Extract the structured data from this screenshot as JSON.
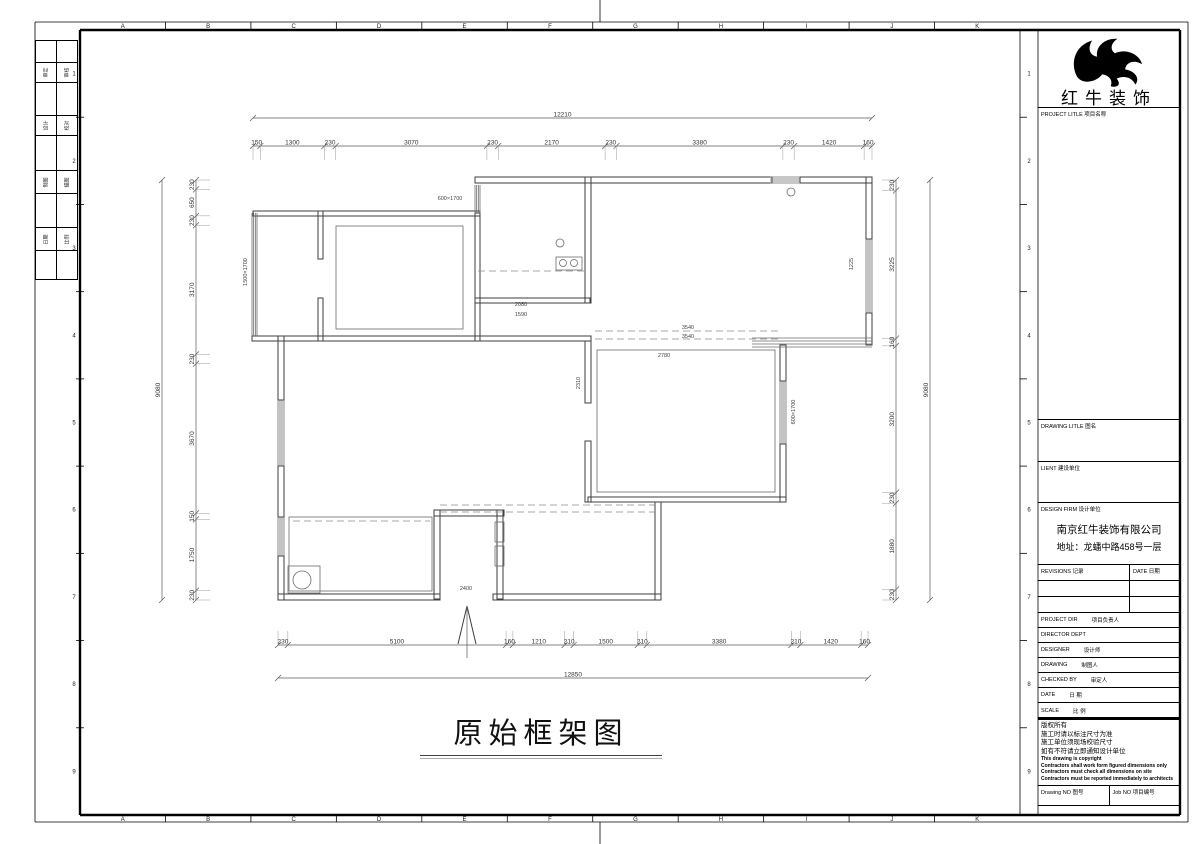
{
  "sheet": {
    "top_letters": [
      "A",
      "B",
      "C",
      "D",
      "E",
      "F",
      "G",
      "H",
      "I",
      "J",
      "K"
    ],
    "side_numbers": [
      "1",
      "2",
      "3",
      "4",
      "5",
      "6",
      "7",
      "8",
      "9"
    ]
  },
  "signature_column": {
    "rows": [
      {
        "h": 22
      },
      {
        "h": 20,
        "cells": [
          "审定",
          "审核"
        ]
      },
      {
        "h": 33
      },
      {
        "h": 20,
        "cells": [
          "设计",
          "校对"
        ]
      },
      {
        "h": 35
      },
      {
        "h": 23,
        "cells": [
          "制图",
          "描图"
        ]
      },
      {
        "h": 34
      },
      {
        "h": 23,
        "cells": [
          "日期",
          "比例"
        ]
      },
      {
        "h": 28
      }
    ]
  },
  "title_block": {
    "brand": "红牛装饰",
    "project_title_label": "PROJECT LITLE  项目名称",
    "drawing_title_label": "DRAWING LITLE  图名",
    "client_label": "LIENT  建设单位",
    "design_firm_label": "DESIGN FIRM  设计单位",
    "firm_name": "南京红牛装饰有限公司",
    "firm_address": "地址：龙蟠中路458号一层",
    "revisions_label": "REVISIONS  记录",
    "date_col_label": "DATE  日期",
    "rows": [
      {
        "label": "PROJECT DIR",
        "cn": "项目负责人"
      },
      {
        "label": "DIRECTOR DEPT",
        "cn": ""
      },
      {
        "label": "DESIGNER",
        "cn": "设计师"
      },
      {
        "label": "DRAWING",
        "cn": "制图人"
      },
      {
        "label": "CHECKED BY",
        "cn": "审定人"
      },
      {
        "label": "DATE",
        "cn": "日  期"
      },
      {
        "label": "SCALE",
        "cn": "比  例"
      }
    ],
    "notes_cn": [
      "版权所有",
      "施工时请以标注尺寸为准",
      "施工单位须现场校验尺寸",
      "如有不符请立即通知设计单位"
    ],
    "notes_en": [
      "This drawing is copyright",
      "Contractors shall work form figured dimensions only",
      "Contractors must check all dimensions on site",
      "Contractors must be reported immediately to architects"
    ],
    "drawing_no_label": "Drawing NO  图号",
    "job_no_label": "Job NO  项目编号"
  },
  "drawing": {
    "title": "原始框架图",
    "walls": [
      [
        253,
        211,
        227,
        5
      ],
      [
        475,
        177,
        297,
        6
      ],
      [
        800,
        177,
        72,
        6
      ],
      [
        866,
        177,
        6,
        62
      ],
      [
        866,
        313,
        6,
        32
      ],
      [
        780,
        345,
        6,
        36
      ],
      [
        780,
        444,
        6,
        58
      ],
      [
        588,
        497,
        198,
        5
      ],
      [
        655,
        502,
        6,
        98
      ],
      [
        278,
        594,
        162,
        6
      ],
      [
        493,
        594,
        168,
        6
      ],
      [
        278,
        336,
        6,
        64
      ],
      [
        278,
        466,
        6,
        51
      ],
      [
        278,
        556,
        6,
        44
      ],
      [
        318,
        211,
        5,
        48
      ],
      [
        318,
        298,
        5,
        43
      ],
      [
        475,
        213,
        5,
        128
      ],
      [
        585,
        177,
        6,
        126
      ],
      [
        475,
        298,
        115,
        5
      ],
      [
        252,
        336,
        339,
        5
      ],
      [
        585,
        341,
        6,
        62
      ],
      [
        585,
        441,
        6,
        61
      ],
      [
        434,
        510,
        6,
        89
      ],
      [
        434,
        510,
        70,
        6
      ],
      [
        497,
        510,
        6,
        89
      ]
    ],
    "windows": [
      [
        252,
        213,
        5,
        123
      ],
      [
        475,
        185,
        5,
        28
      ],
      [
        770,
        177,
        30,
        6
      ],
      [
        866,
        239,
        6,
        74
      ],
      [
        752,
        338,
        120,
        9
      ],
      [
        780,
        381,
        6,
        63
      ],
      [
        278,
        400,
        6,
        66
      ],
      [
        278,
        517,
        6,
        39
      ]
    ],
    "inner_rects": [
      [
        336,
        226,
        127,
        103
      ],
      [
        597,
        350,
        178,
        142
      ],
      [
        289,
        517,
        143,
        74
      ],
      [
        288,
        566,
        32,
        27
      ],
      [
        556,
        257,
        26,
        13
      ],
      [
        495,
        522,
        9,
        20
      ],
      [
        495,
        546,
        9,
        20
      ]
    ],
    "dashed": [
      [
        478,
        271,
        585,
        271
      ],
      [
        595,
        331,
        778,
        331
      ],
      [
        595,
        339,
        778,
        339
      ],
      [
        440,
        505,
        655,
        505
      ],
      [
        440,
        512,
        655,
        512
      ],
      [
        293,
        521,
        430,
        521
      ]
    ],
    "circles": [
      [
        302,
        580,
        9
      ],
      [
        563,
        263,
        3.5
      ],
      [
        574,
        263,
        3.5
      ],
      [
        560,
        243,
        4
      ],
      [
        791,
        192,
        4
      ]
    ],
    "entry_arrow": {
      "points": "458,644 467,606 476,644",
      "stem": [
        467,
        606,
        467,
        658
      ]
    },
    "annotations": [
      [
        466,
        590,
        "2400",
        0
      ],
      [
        664,
        357,
        "2780",
        0
      ],
      [
        688,
        329,
        "3540",
        0
      ],
      [
        688,
        338,
        "3540",
        0
      ],
      [
        450,
        200,
        "600×1700",
        0
      ],
      [
        795,
        412,
        "600×1700",
        -90
      ],
      [
        853,
        264,
        "1225",
        -90
      ],
      [
        521,
        306,
        "2080",
        0
      ],
      [
        521,
        316,
        "1590",
        0
      ],
      [
        580,
        383,
        "2310",
        -90
      ],
      [
        247,
        272,
        "1500×1700",
        -90
      ]
    ],
    "dims": {
      "top_overall": {
        "y": 118,
        "x1": 253,
        "x2": 872,
        "label": "12210"
      },
      "top_chain": {
        "y": 146,
        "x1": 253,
        "x2": 872,
        "guide": "down",
        "values": [
          "150",
          "1300",
          "230",
          "3070",
          "230",
          "2170",
          "230",
          "3380",
          "230",
          "1420",
          "160"
        ]
      },
      "bottom_chain": {
        "y": 645,
        "x1": 278,
        "x2": 868,
        "guide": "up",
        "values": [
          "230",
          "5100",
          "160",
          "1210",
          "210",
          "1500",
          "210",
          "3380",
          "210",
          "1420",
          "160"
        ]
      },
      "bottom_overall": {
        "y": 678,
        "x1": 278,
        "x2": 868,
        "label": "12850"
      },
      "left_chain": {
        "x": 196,
        "y1": 180,
        "y2": 600,
        "guide": "right",
        "values": [
          "230",
          "650",
          "230",
          "3170",
          "230",
          "3670",
          "150",
          "1750",
          "230"
        ]
      },
      "left_overall": {
        "x": 162,
        "y1": 180,
        "y2": 600,
        "label": "9080"
      },
      "right_chain": {
        "x": 896,
        "y1": 180,
        "y2": 600,
        "guide": "left",
        "values": [
          "230",
          "3225",
          "160",
          "3200",
          "230",
          "1880",
          "230"
        ]
      },
      "right_overall": {
        "x": 930,
        "y1": 180,
        "y2": 600,
        "label": "9080"
      }
    }
  }
}
